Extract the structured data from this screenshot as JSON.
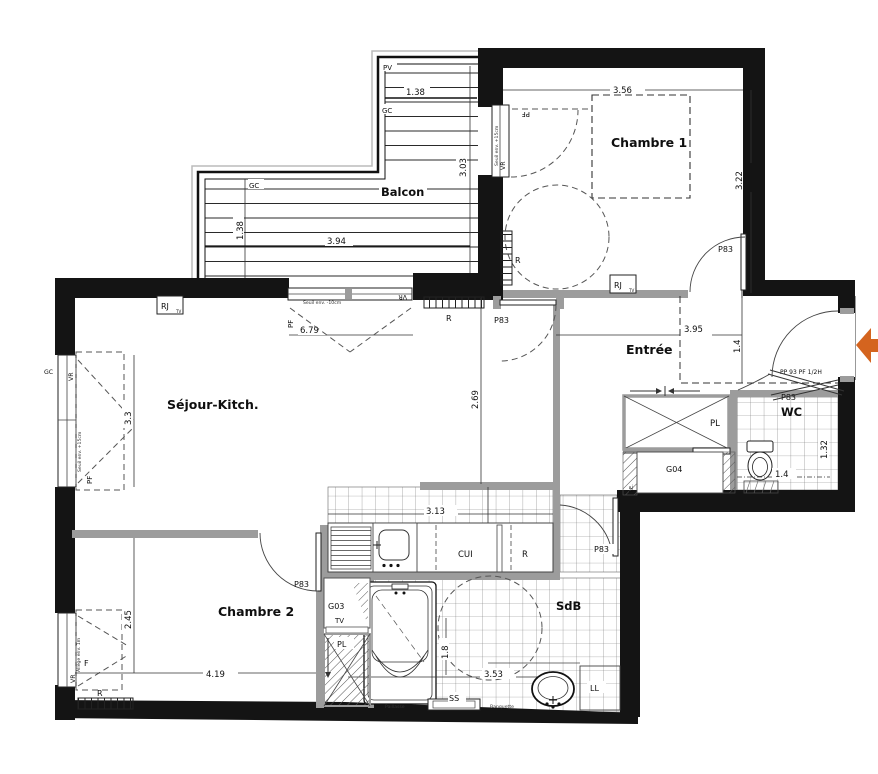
{
  "plan_title": "Apartment floor plan",
  "rooms": {
    "balcon": "Balcon",
    "chambre1": "Chambre 1",
    "sejour": "Séjour-Kitch.",
    "entree": "Entrée",
    "wc": "WC",
    "chambre2": "Chambre 2",
    "sdb": "SdB",
    "cui": "CUI"
  },
  "dims": {
    "balcony_upper_width": "1.38",
    "balcony_upper_depth": "3.03",
    "balcony_lower_depth": "1.38",
    "balcony_lower_width": "3.94",
    "chambre1_width": "3.56",
    "chambre1_depth": "3.22",
    "sejour_bay_width": "6.79",
    "entree_width": "3.95",
    "entree_depth": "1.4",
    "sejour_window": "3.3",
    "sejour_depth": "2.69",
    "chambre2_depth": "2.45",
    "chambre2_width": "4.19",
    "kitchen_width": "3.13",
    "kitchen_depth": "1.25",
    "wc_depth": "1.32",
    "wc_width": "1.4",
    "sdb_width": "3.53",
    "bathtub_length": "1.8"
  },
  "labels": {
    "pv": "PV",
    "gc": "GC",
    "pf": "PF",
    "vr": "VR",
    "f": "F",
    "r": "R",
    "rj": "RJ",
    "tv": "TV",
    "tv_sub": "TV",
    "p83": "P83",
    "pl": "PL",
    "g03": "G03",
    "g04": "G04",
    "ll": "LL",
    "ss": "SS",
    "te": "T.E."
  },
  "annotations": {
    "entrance_door": "PP 93 PF 1/2H",
    "seuil_minus10": "Seuil env. -10cm",
    "seuil_plus15": "Seuil env. +15cm",
    "allege": "Allège env. 1m",
    "paillasse": "Paillasse",
    "banquette": "Banquette"
  },
  "colors": {
    "wall": "#141414",
    "partition": "#9c9c9c",
    "entry_arrow": "#d4641f"
  }
}
